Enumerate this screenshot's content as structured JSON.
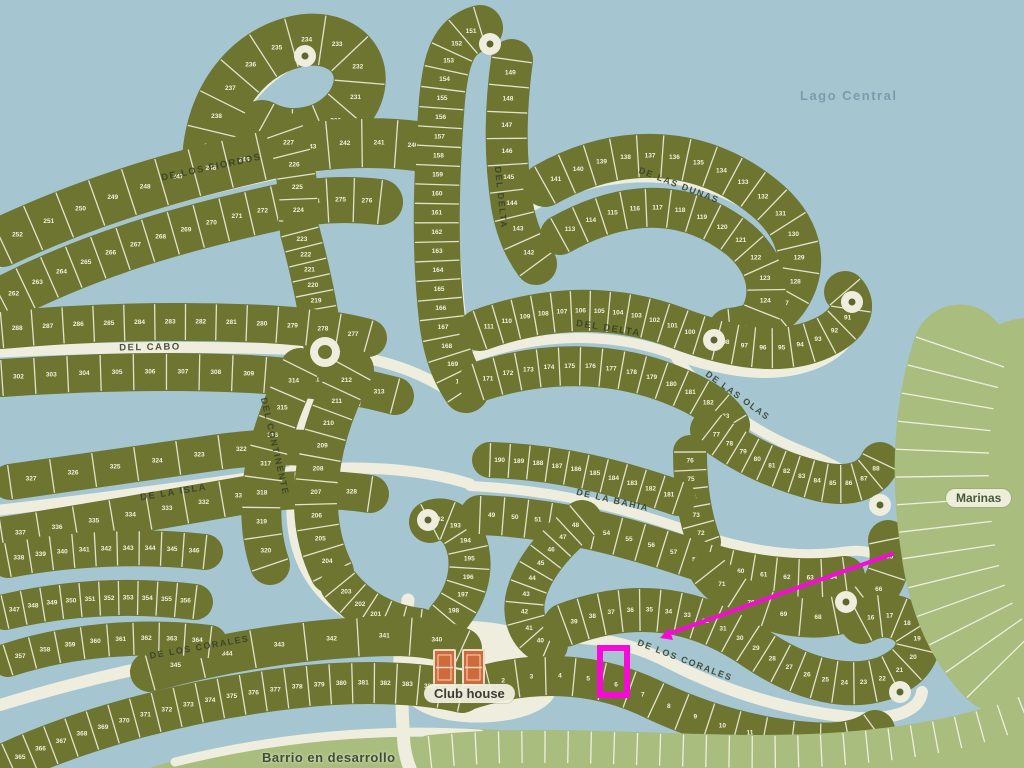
{
  "map": {
    "labels": {
      "lake": "Lago Central",
      "marinas": "Marinas",
      "club_house": "Club house",
      "barrio": "Barrio en desarrollo"
    },
    "colors": {
      "water": "#a5c6d1",
      "lot_green": "#6d7531",
      "rib_cream": "#e9e9d5",
      "road_cream": "#efeede",
      "light_green": "#a9bd7e",
      "street_text": "#39422a",
      "annotation_magenta": "#f70ad6",
      "court_orange": "#cf6a3a"
    },
    "street_labels": [
      {
        "text": "DE LOS FIORDOS",
        "x": 212,
        "y": 170,
        "rot": -12,
        "size": 9.5
      },
      {
        "text": "DEL CABO",
        "x": 150,
        "y": 350,
        "rot": -1,
        "size": 9.5
      },
      {
        "text": "DE LA ISLA",
        "x": 174,
        "y": 495,
        "rot": -9,
        "size": 9.5
      },
      {
        "text": "DEL CONTINENTE",
        "x": 272,
        "y": 447,
        "rot": 77,
        "size": 9
      },
      {
        "text": "DEL DELTA",
        "x": 498,
        "y": 198,
        "rot": 84,
        "size": 9
      },
      {
        "text": "DEL DELTA",
        "x": 608,
        "y": 331,
        "rot": 9,
        "size": 9.5
      },
      {
        "text": "DE LAS DUNAS",
        "x": 678,
        "y": 188,
        "rot": 21,
        "size": 9
      },
      {
        "text": "DE LAS OLAS",
        "x": 736,
        "y": 398,
        "rot": 36,
        "size": 9
      },
      {
        "text": "DE LA BAHIA",
        "x": 612,
        "y": 503,
        "rot": 13,
        "size": 9
      },
      {
        "text": "DE LOS CORALES",
        "x": 200,
        "y": 650,
        "rot": -10,
        "size": 9
      },
      {
        "text": "DE LOS CORALES",
        "x": 684,
        "y": 663,
        "rot": 21,
        "size": 9
      }
    ],
    "areas": [
      {
        "name": "marinas-area",
        "fill": "light",
        "d": "M 1024,318 C 985,322 950,352 938,400 C 922,462 924,540 944,596 C 960,640 990,668 1024,674 Z"
      },
      {
        "name": "bottom-strip",
        "fill": "light",
        "d": "M 150,768 C 230,742 320,730 420,728 C 540,726 620,748 740,748 C 860,748 950,728 1024,700 L 1024,768 Z"
      },
      {
        "name": "clubhouse-plaza",
        "fill": "cream",
        "d": "M 396,630 C 440,616 505,618 538,636 C 562,650 566,678 552,700 C 532,724 468,728 432,716 C 404,706 392,688 393,664 Z"
      }
    ],
    "roads": [
      {
        "name": "road-fiordos",
        "w": 11,
        "d": "M 0,262 C 95,218 190,192 285,172 C 340,160 390,158 438,166"
      },
      {
        "name": "road-paddle-stem",
        "w": 11,
        "d": "M 215,185 C 222,130 252,82 298,60"
      },
      {
        "name": "road-cabo",
        "w": 11,
        "d": "M 0,352 C 100,347 210,346 310,350"
      },
      {
        "name": "road-cabo-ext",
        "w": 11,
        "d": "M 340,354 C 390,360 430,376 458,398"
      },
      {
        "name": "road-isla",
        "w": 11,
        "d": "M 0,510 C 90,500 190,486 290,472 C 350,464 420,468 470,484"
      },
      {
        "name": "road-continente",
        "w": 11,
        "d": "M 325,360 C 302,420 290,468 292,515 C 294,560 315,595 350,615 C 375,628 400,640 415,652"
      },
      {
        "name": "road-delta-v",
        "w": 10,
        "d": "M 464,340 C 452,255 450,165 462,80 C 466,56 476,46 488,44"
      },
      {
        "name": "road-dunas",
        "w": 10,
        "d": "M 525,210 C 612,162 700,170 760,214 C 798,243 806,276 788,305 C 772,328 745,338 718,338"
      },
      {
        "name": "road-delta-h",
        "w": 10,
        "d": "M 470,358 C 542,332 612,332 672,354 C 734,376 784,380 824,360 C 854,344 862,320 846,305"
      },
      {
        "name": "road-olas",
        "w": 10,
        "d": "M 676,358 C 706,396 748,428 795,448 C 838,465 868,482 878,502"
      },
      {
        "name": "road-bahia",
        "w": 10,
        "d": "M 470,486 C 560,490 630,510 692,532 C 750,552 800,558 842,552 C 885,545 895,570 868,592 C 858,600 850,602 846,602"
      },
      {
        "name": "road-corales-left",
        "w": 12,
        "d": "M 0,705 C 95,676 200,652 305,644 C 370,638 430,642 465,658"
      },
      {
        "name": "road-corales-center",
        "w": 12,
        "d": "M 465,658 C 540,628 610,632 668,662 C 730,694 792,712 858,718 C 900,720 920,708 922,692"
      },
      {
        "name": "road-clubhouse",
        "w": 13,
        "d": "M 408,600 C 402,640 400,690 404,745 C 406,758 408,764 410,768"
      },
      {
        "name": "road-bottom-a",
        "w": 9,
        "d": "M 175,762 C 280,736 380,728 480,734"
      },
      {
        "name": "road-bottom-b",
        "w": 9,
        "d": "M 520,740 C 620,752 760,756 880,742 C 950,734 1000,720 1024,706"
      },
      {
        "name": "road-marinas",
        "w": 9,
        "d": "M 990,360 C 972,420 966,490 974,552 C 980,600 998,638 1024,656"
      }
    ],
    "bands": [
      {
        "name": "paddle-nw",
        "w": 52,
        "from": 239,
        "to": 228,
        "d": "M 208,162 C 210,100 248,48 305,40 C 352,36 372,72 352,104 C 332,134 290,142 262,126"
      },
      {
        "name": "fiordos-north",
        "w": 50,
        "from": 252,
        "to": 240,
        "d": "M 2,242 C 100,196 190,172 280,152 C 330,142 380,140 430,148"
      },
      {
        "name": "fiordos-south",
        "w": 46,
        "from": 262,
        "to": 276,
        "d": "M 2,300 C 95,252 185,228 275,208 C 310,200 345,198 380,202"
      },
      {
        "name": "column-ne-a",
        "w": 40,
        "from": 227,
        "to": 224,
        "d": "M 285,132 C 295,160 300,190 298,222"
      },
      {
        "name": "column-ne-b",
        "w": 40,
        "from": 223,
        "to": 217,
        "d": "M 300,232 C 310,270 318,305 322,340"
      },
      {
        "name": "cabo-north",
        "w": 38,
        "from": 288,
        "to": 277,
        "d": "M 2,330 C 90,322 180,320 265,324 C 300,326 340,330 368,338"
      },
      {
        "name": "cabo-south",
        "w": 38,
        "from": 302,
        "to": 313,
        "d": "M 2,378 C 90,372 170,370 250,374 C 300,377 350,384 395,396"
      },
      {
        "name": "isla-north",
        "w": 36,
        "from": 327,
        "to": 321,
        "d": "M 10,482 C 80,472 150,462 220,452 C 250,448 280,446 305,448"
      },
      {
        "name": "isla-south",
        "w": 38,
        "from": 337,
        "to": 328,
        "d": "M 2,536 C 80,524 160,510 240,496 C 280,489 330,488 370,494"
      },
      {
        "name": "continente-west",
        "w": 40,
        "from": 314,
        "to": 320,
        "d": "M 300,368 C 280,408 265,450 262,492 C 260,518 262,542 270,565"
      },
      {
        "name": "continente-east",
        "w": 44,
        "from": 212,
        "to": 204,
        "d": "M 352,370 C 330,410 318,450 316,492 C 315,520 320,548 332,572"
      },
      {
        "name": "continente-south",
        "w": 40,
        "from": 203,
        "to": 199,
        "d": "M 340,585 C 360,610 390,625 420,628"
      },
      {
        "name": "center-hook",
        "w": 42,
        "from": 198,
        "to": 192,
        "d": "M 448,618 C 468,595 475,565 465,540 C 458,522 442,515 430,522"
      },
      {
        "name": "delta-v-west",
        "w": 46,
        "from": 151,
        "to": 170,
        "d": "M 480,28 C 452,36 446,60 442,100 C 436,180 434,250 442,320 C 446,352 454,372 466,390"
      },
      {
        "name": "delta-v-east",
        "w": 42,
        "from": 149,
        "to": 142,
        "d": "M 512,60 C 505,110 505,160 512,205 C 516,228 524,248 536,264"
      },
      {
        "name": "dunas-north",
        "w": 44,
        "from": 141,
        "to": 125,
        "d": "M 545,185 C 625,140 705,150 762,196 C 800,226 808,262 790,294 C 778,315 755,328 730,330"
      },
      {
        "name": "dunas-south",
        "w": 40,
        "from": 113,
        "to": 124,
        "d": "M 560,235 C 630,196 690,200 740,240 C 765,262 772,288 762,312"
      },
      {
        "name": "delta-h-north",
        "w": 42,
        "from": 111,
        "to": 90,
        "d": "M 480,330 C 550,305 615,305 675,327 C 735,350 785,355 822,338 C 850,325 858,306 845,292"
      },
      {
        "name": "delta-h-south",
        "w": 40,
        "from": 171,
        "to": 183,
        "d": "M 478,382 C 545,360 610,362 665,382 C 700,395 720,408 730,425"
      },
      {
        "name": "olas-south",
        "w": 40,
        "from": 77,
        "to": 88,
        "d": "M 710,430 C 742,455 780,472 822,482 C 852,488 872,480 880,462"
      },
      {
        "name": "olas-column",
        "w": 34,
        "from": 76,
        "to": 72,
        "d": "M 690,452 C 690,485 694,515 704,542"
      },
      {
        "name": "bahia-north",
        "w": 36,
        "from": 190,
        "to": 181,
        "d": "M 490,460 C 560,462 620,478 678,498"
      },
      {
        "name": "bahia-south",
        "w": 40,
        "from": 49,
        "to": 64,
        "d": "M 480,515 C 560,518 630,538 690,558 C 745,576 800,582 845,576"
      },
      {
        "name": "bahia-hook",
        "w": 40,
        "from": 65,
        "to": 71,
        "d": "M 888,540 C 895,572 880,600 848,612 C 818,622 785,618 755,605 C 735,596 720,585 710,572"
      },
      {
        "name": "bahia-west-hook",
        "w": 40,
        "from": 48,
        "to": 40,
        "d": "M 582,520 C 552,545 530,572 525,600 C 522,620 530,638 548,645"
      },
      {
        "name": "corales-center-north",
        "w": 44,
        "from": 39,
        "to": 16,
        "d": "M 565,625 C 640,597 700,610 755,648 C 805,682 850,690 885,678 C 915,666 925,645 912,628 C 900,614 880,612 862,622"
      },
      {
        "name": "corales-center-south",
        "w": 40,
        "from": 1,
        "to": 15,
        "d": "M 462,692 C 530,668 595,672 650,698 C 700,722 755,738 810,742 C 840,744 862,740 875,730"
      },
      {
        "name": "corales-left-north",
        "w": 40,
        "from": 345,
        "to": 340,
        "d": "M 150,672 C 230,650 310,638 390,636 C 420,636 445,640 462,648"
      },
      {
        "name": "corales-left-south",
        "w": 42,
        "from": 365,
        "to": 385,
        "d": "M 10,762 C 90,726 190,700 290,688 C 355,680 420,682 462,692"
      },
      {
        "name": "isla-sw-a",
        "w": 36,
        "from": 338,
        "to": 346,
        "d": "M 8,560 C 70,548 140,545 205,552"
      },
      {
        "name": "isla-sw-b",
        "w": 36,
        "from": 347,
        "to": 356,
        "d": "M 5,612 C 65,598 130,594 195,602"
      },
      {
        "name": "isla-sw-c",
        "w": 34,
        "from": 357,
        "to": 364,
        "d": "M 8,660 C 70,640 140,634 210,642"
      },
      {
        "name": "marinas-slips",
        "w": 95,
        "ribs": 13,
        "light": true,
        "d": "M 960,352 C 940,410 938,480 948,545 C 955,600 975,640 1000,665"
      },
      {
        "name": "barrio-ribs",
        "w": 34,
        "ribs": 26,
        "light": true,
        "d": "M 430,752 C 560,738 700,758 830,750 C 920,744 980,730 1024,712"
      }
    ],
    "roundabouts": [
      {
        "x": 325,
        "y": 352
      }
    ],
    "culdesacs": [
      {
        "x": 305,
        "y": 56
      },
      {
        "x": 490,
        "y": 44
      },
      {
        "x": 852,
        "y": 302
      },
      {
        "x": 880,
        "y": 505
      },
      {
        "x": 846,
        "y": 602
      },
      {
        "x": 900,
        "y": 692
      },
      {
        "x": 428,
        "y": 520
      },
      {
        "x": 714,
        "y": 340
      }
    ],
    "club_house": {
      "courts": [
        {
          "x": 434,
          "y": 650,
          "w": 21,
          "h": 35
        },
        {
          "x": 463,
          "y": 650,
          "w": 21,
          "h": 35
        }
      ]
    },
    "annotations": {
      "highlight_rect": {
        "x": 600,
        "y": 648,
        "w": 27,
        "h": 47,
        "stroke_w": 6
      },
      "pointer_line": {
        "x1": 892,
        "y1": 554,
        "x2": 668,
        "y2": 634,
        "stroke_w": 4
      },
      "arrow_head": "660,638 669,628 673,640"
    },
    "overlay_positions": {
      "lake": {
        "left": 800,
        "top": 88
      },
      "marinas": {
        "left": 946,
        "top": 489
      },
      "club": {
        "left": 424,
        "top": 684
      },
      "barrio": {
        "left": 262,
        "top": 750
      }
    }
  }
}
